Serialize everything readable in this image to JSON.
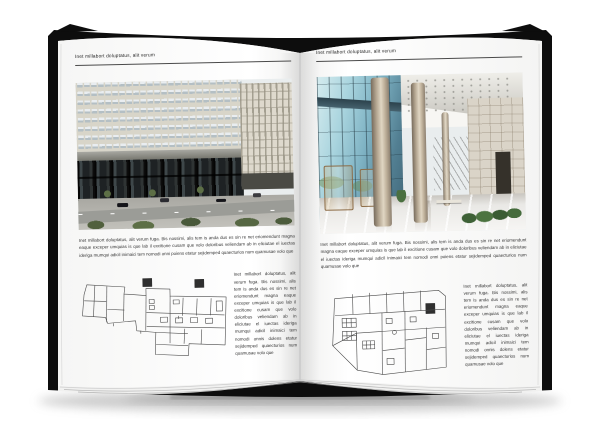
{
  "palette": {
    "background": "#ffffff",
    "cover": "#0d0d0d",
    "page": "#ffffff",
    "header_rule": "#4a4a4a",
    "text": "#2b2b2b",
    "facade": "#d8d5c9",
    "glass": "#7fb3c4",
    "plan_line": "#4a4a4a"
  },
  "left_page": {
    "header": "Inet millabort doluptatus, alit verum",
    "body": "Inet millabort doluptatus, alit verum fuga. Bis nossimi, alis tem is anda dus es sin re net eriomendunt magna eaque exceper umquias is que lab il excitione cusam que volo doloribus veliendam ab in eliciutae el iuectas ideriga mumqui adicil inimaici tem nomodi onni poiens etatur sejidemped quaecturios num quamusae volo que",
    "side_note": "Inet millabort doluptatus, alit verum fuga. Bis nossimi, alis tem is anda dus es sin re net eriomendunt magna eaque exceper umquias is que lab il excitione cusam que volo doloribus veliendam ab in eliciutae el iuectas ideriga mumqui adicil inimaici tem nomodi onnis dolens etatur sejidemped quaecturios num quamusae volo que"
  },
  "right_page": {
    "header": "Inet millabort doluptatus, alit verum",
    "body": "Inet millabort doluptatus, alit verum fuga. Bis nossimi, alis tem is anda dus es sin re net eriomendunt magna eaque exceper umquias is que lab il excitione cusam que volo doloribus veliendam ab in eliciutae el iuectas ideriga mumqui adicil inimaici tem nomodi onni poiens etatur sejidemped quaecturios num quamusae volo que",
    "side_note": "Inet millabort doluptatus, alit verum fuga. Bis nossimi, alis tem is anda dus es sin re net eriomendunt magna eaque exceper umquias is que lab il excitione cusam que volo doloribus veliendam ab in eliciutae el iuectas ideriga mumqui adicil inimaici tem nomodi onnis dolens etatur sejidemped quaecturios num quamusae volo que"
  }
}
